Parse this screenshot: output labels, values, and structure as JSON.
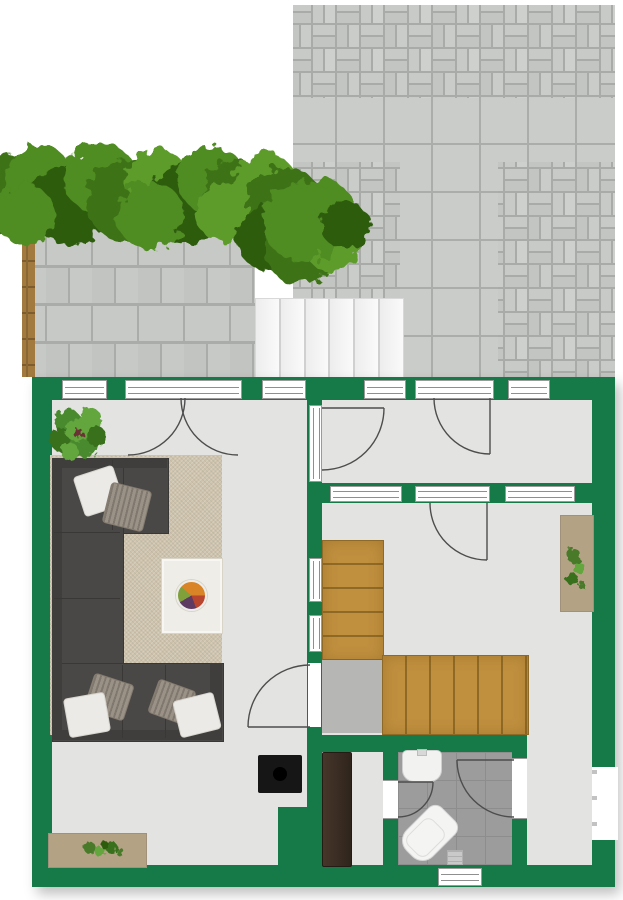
{
  "meta": {
    "kind": "floor-plan",
    "view": "top-down architectural rendering",
    "visible_text": "none"
  },
  "palette": {
    "wall_green": "#157a48",
    "interior_floor": "#e3e4e1",
    "stair_wood": "#c0903f",
    "stair_landing_gray": "#b6b6b4",
    "rug_beige": "#cdc3ad",
    "sofa_gray": "#4a4846",
    "paving_gray": "#c9ccc8",
    "paving_grout": "#a8aba7",
    "bathroom_tile": "#9c9c9c",
    "dark_cabinet": "#3b2d23",
    "sideboard_beige": "#b3a284",
    "stove_black": "#161616",
    "fence_brown": "#a2793f",
    "steps_white": "#f4f4f4",
    "foliage_greens": [
      "#3c7317",
      "#4f8c20",
      "#2e5c11",
      "#5d9c2a"
    ]
  },
  "outdoor": {
    "areas": [
      {
        "name": "patio-basketweave-paving"
      },
      {
        "name": "large-paver-band"
      },
      {
        "name": "large-paver-walkway"
      },
      {
        "name": "left-patio-running-bond"
      },
      {
        "name": "garden-fence"
      },
      {
        "name": "entry-steps",
        "step_count": 6
      },
      {
        "name": "hedge-row"
      },
      {
        "name": "large-bush"
      }
    ]
  },
  "rooms": [
    {
      "name": "living-room",
      "furniture": [
        "corner-sofa",
        "throw-pillows",
        "area-rug",
        "coffee-table",
        "fruit-bowl",
        "wood-stove",
        "sideboard-with-plants",
        "houseplant"
      ]
    },
    {
      "name": "vestibule",
      "furniture": []
    },
    {
      "name": "stair-hall",
      "furniture": [
        "l-shaped-wood-stairs",
        "tall-dark-cabinet",
        "plant-cabinet"
      ]
    },
    {
      "name": "bathroom",
      "fixtures": [
        "sink",
        "toilet",
        "floor-drain"
      ]
    },
    {
      "name": "rear-corridor",
      "furniture": []
    }
  ],
  "openings": {
    "window_count": 10,
    "door_count": 7,
    "has_double_french_door": true,
    "swing_arc_color": "#4d4d4d"
  }
}
